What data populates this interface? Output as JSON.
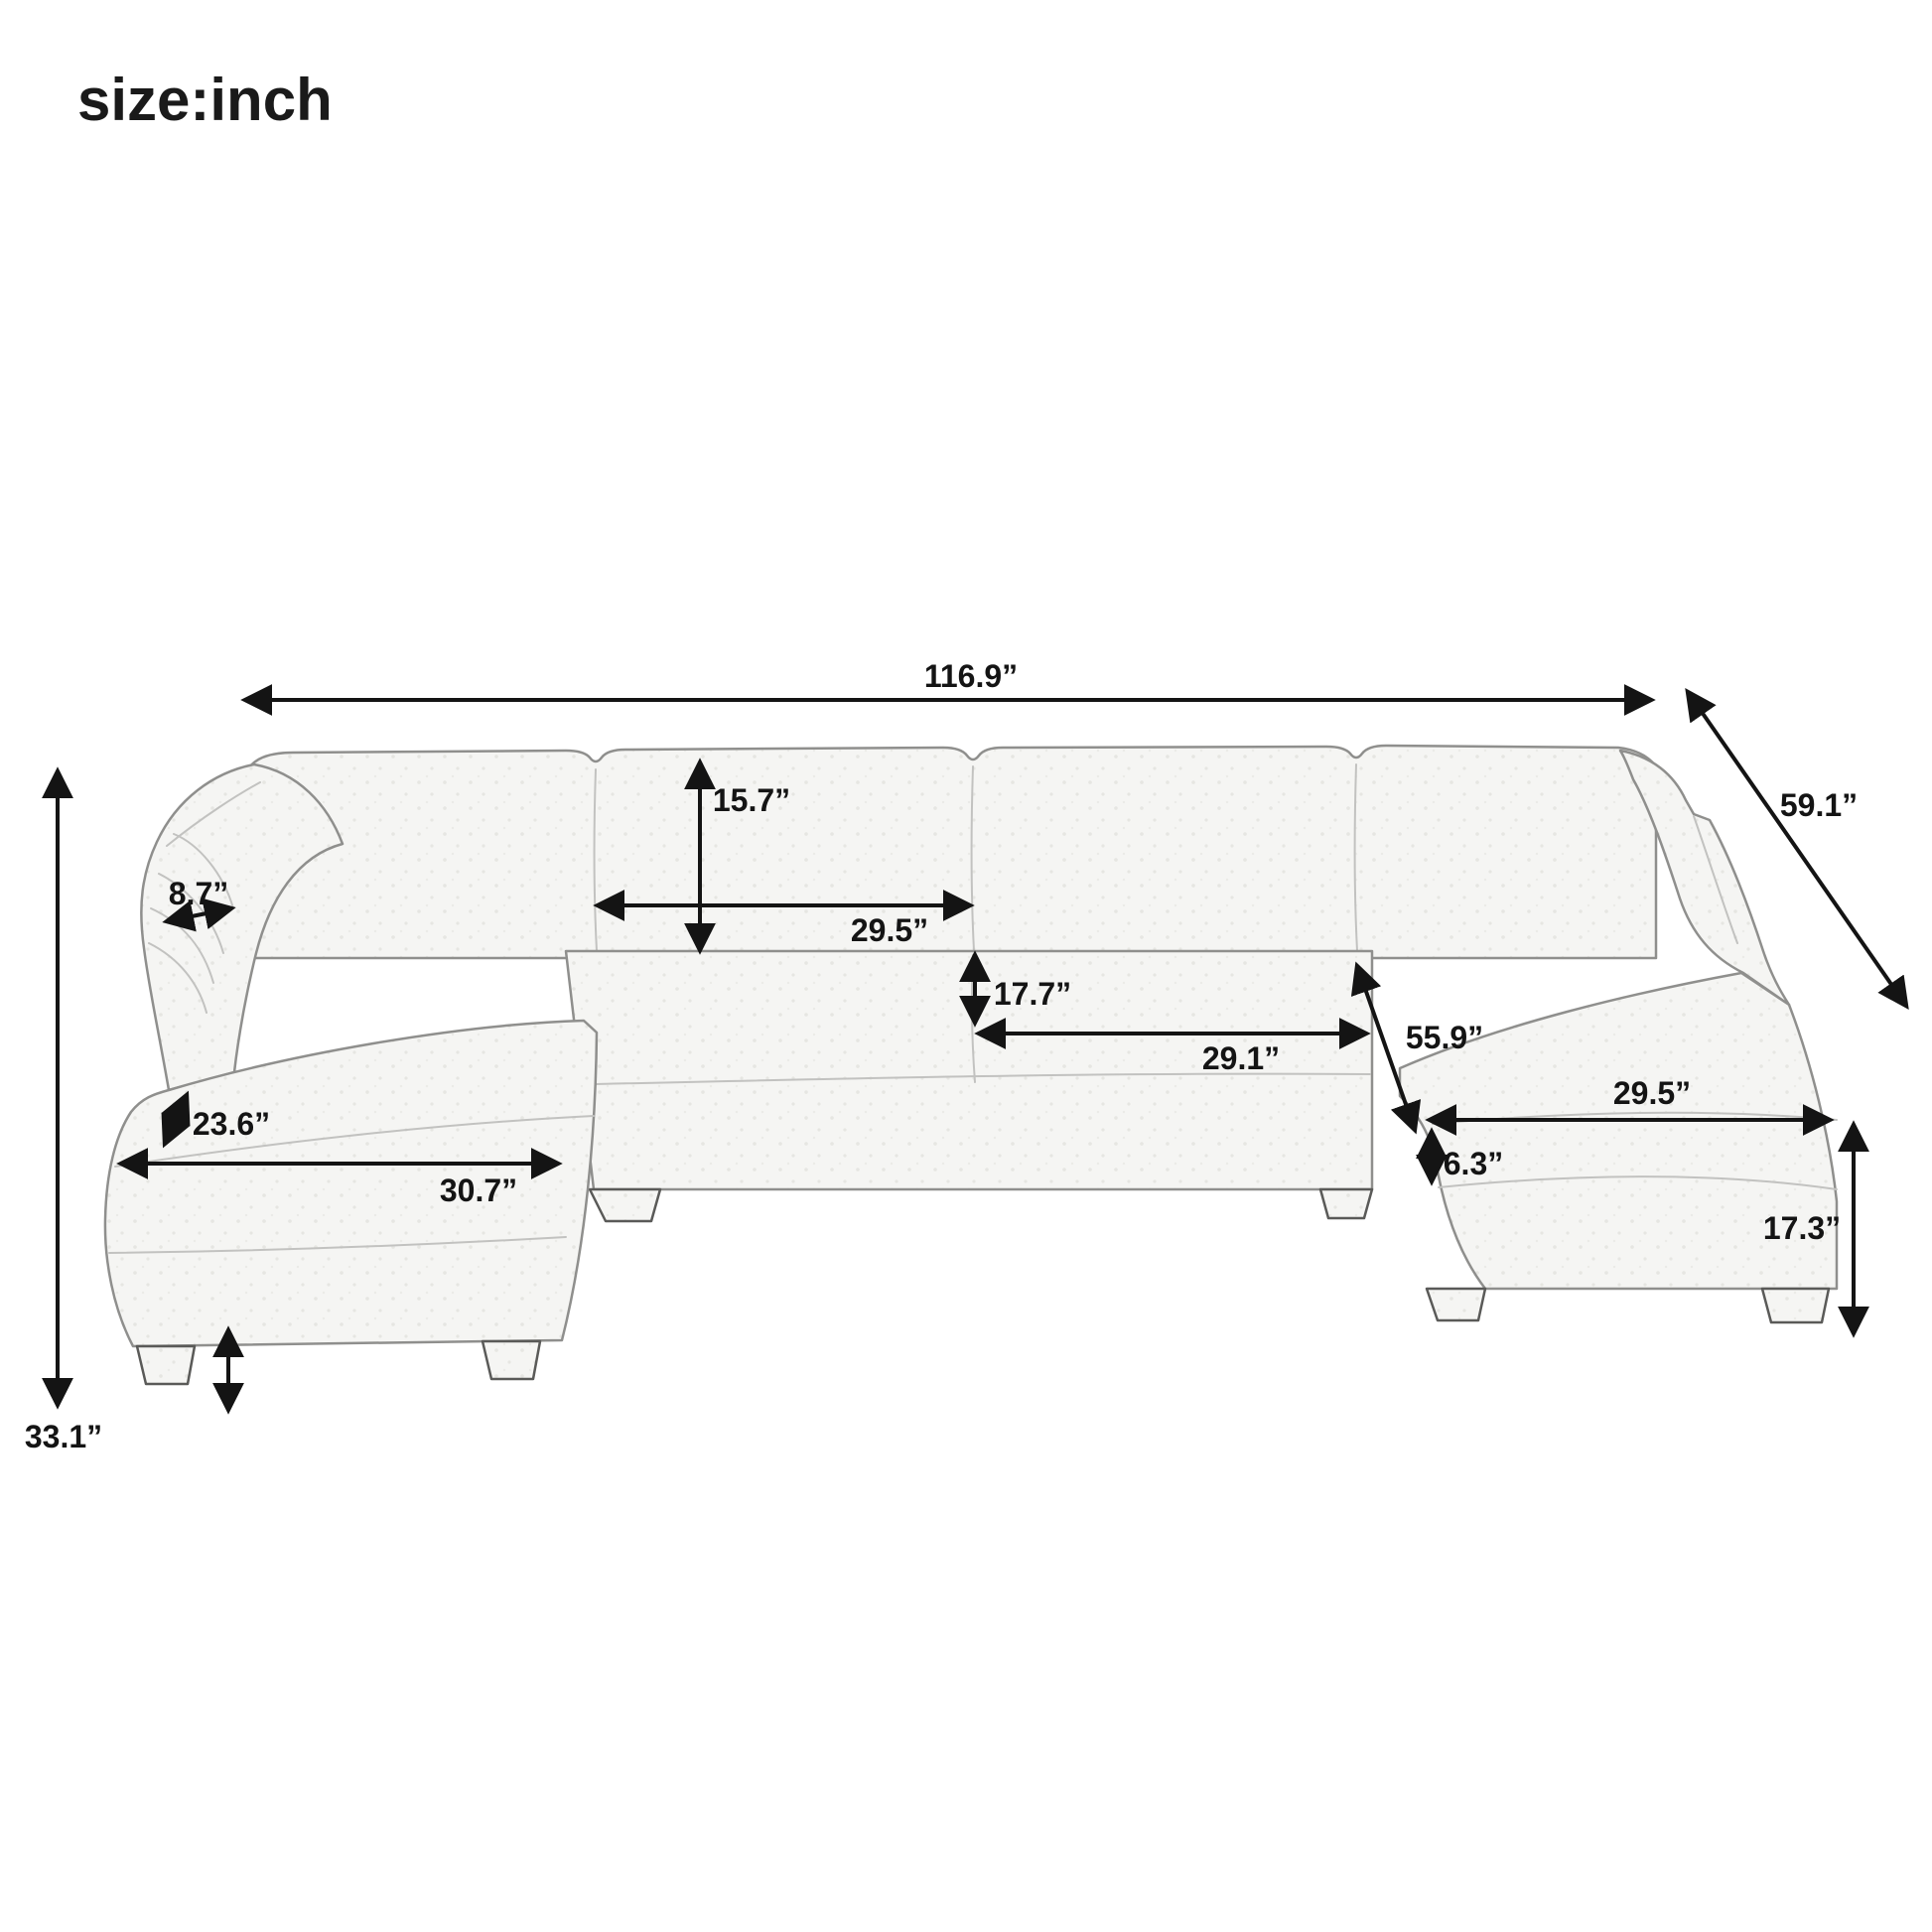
{
  "title": "size:inch",
  "diagram": {
    "subject": "U-shaped sectional sofa dimension drawing",
    "unit": "inch",
    "dimensions": {
      "overall_width": "116.9”",
      "overall_depth": "59.1”",
      "overall_height": "33.1”",
      "back_cushion_height": "15.7”",
      "back_cushion_width": "29.5”",
      "seat_back_height": "17.7”",
      "seat_cushion_width": "29.1”",
      "interior_width": "55.9”",
      "chaise_cushion_width": "29.5”",
      "seat_cushion_thickness": "6.3”",
      "chaise_seat_height": "17.3”",
      "left_chaise_depth": "23.6”",
      "left_chaise_width": "30.7”",
      "armrest_width": "8.7”"
    }
  }
}
